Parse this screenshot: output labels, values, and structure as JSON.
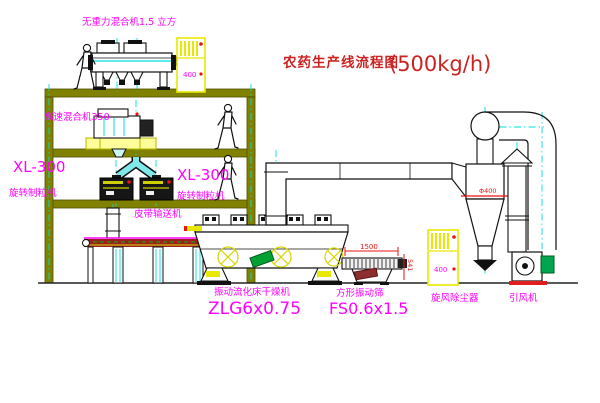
{
  "diagram": {
    "title": "农药生产线流程图",
    "title_capacity": "(500kg/h)"
  },
  "labels": {
    "gravity_mixer": "无重力混合机1.5 立方",
    "high_speed_mixer": "高速混合机350",
    "granulator_left_model": "XL-300",
    "granulator_left_name": "旋转制粒机",
    "granulator_center_model": "XL-300",
    "granulator_center_name": "旋转制粒机",
    "belt_conveyor": "皮带输送机",
    "fluid_bed_dryer": "振动流化床干燥机",
    "fluid_bed_dryer_model": "ZLG6x0.75",
    "vibrating_screen": "方形振动筛",
    "vibrating_screen_model": "FS0.6x1.5",
    "cyclone": "旋风除尘器",
    "fan": "引风机"
  },
  "dimensions": {
    "screen_length": "1500",
    "screen_height": "541",
    "cyclone_diameter": "Φ400"
  },
  "cabinets": {
    "upper_panel_text": "400",
    "lower_panel_text": "400"
  },
  "colors": {
    "label_magenta": "#ff00ff",
    "title_red": "#cc2222",
    "dimension_red": "#ee1111",
    "structure_olive": "#818100",
    "centerline_cyan": "#00dede",
    "equipment_yellow": "#e8e800",
    "motor_green": "#00a550",
    "conveyor_red": "#9c2020"
  }
}
